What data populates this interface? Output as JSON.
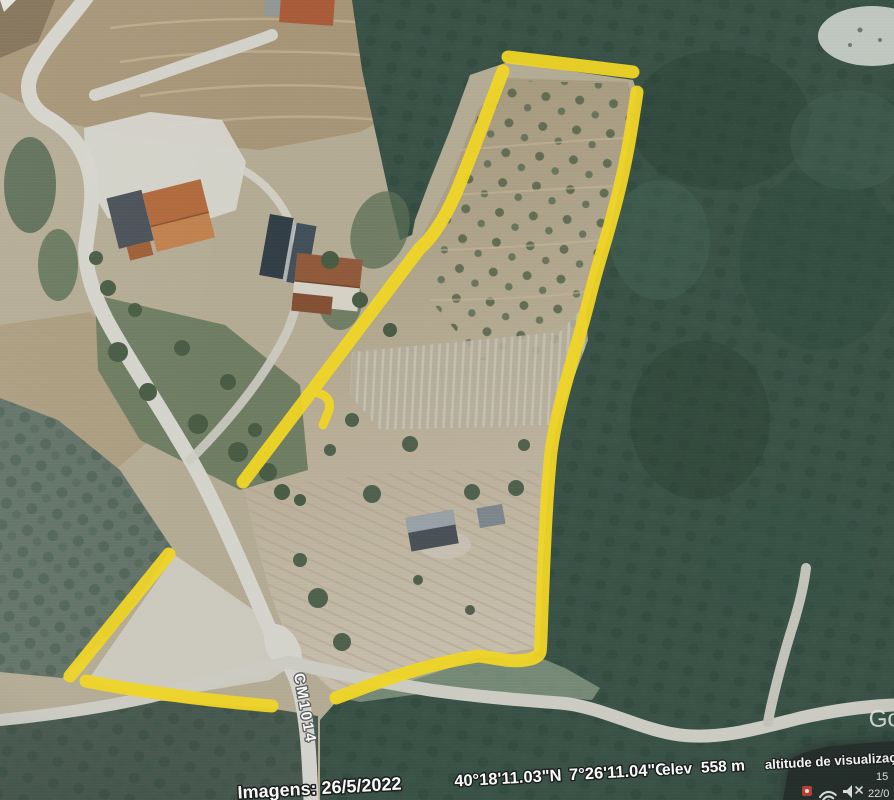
{
  "map": {
    "road_label": "CM1014",
    "watermark_partial": "Go"
  },
  "status_bar": {
    "imagery_date": "Imagens: 26/5/2022",
    "latitude": "40°18'11.03\"N",
    "longitude": "7°26'11.04\"O",
    "elevation_label": "elev",
    "elevation_value": "558 m",
    "view_altitude_label": "altitude de visualização"
  },
  "system_tray": {
    "time": "15",
    "date": "22/0"
  },
  "annotation": {
    "boundary_color": "#f7d716"
  },
  "colors": {
    "forest_dark": "#2e463a",
    "field_tan": "#b4a88f",
    "road_light": "#d6d2c8",
    "label_text": "#ffffff"
  }
}
